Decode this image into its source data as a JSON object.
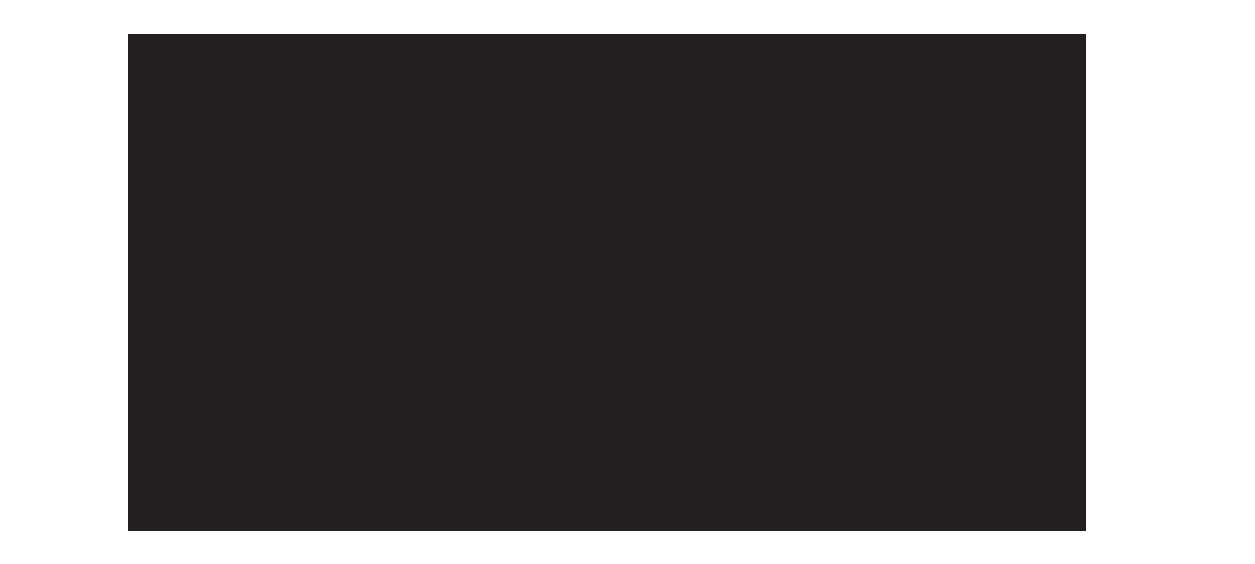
{
  "page": {
    "background_color": "#ffffff"
  },
  "screen": {
    "description": "blank-dark-screen",
    "background_color": "#231f20",
    "content_text": ""
  }
}
